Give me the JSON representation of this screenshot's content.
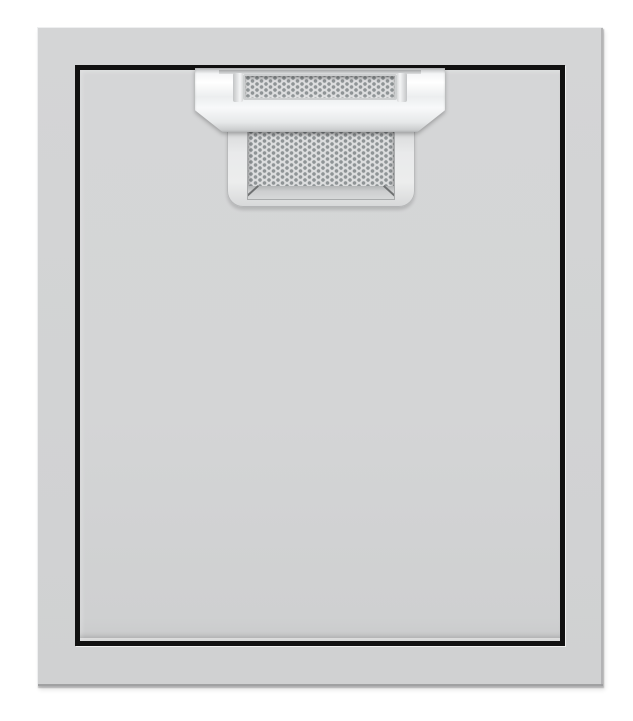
{
  "image": {
    "description": "Product photo of a brushed stainless steel single access door with a black reveal and a top-center pull handle that has a perforated metal insert and a recessed perforated finger pocket"
  },
  "colors": {
    "bg": "#ffffff",
    "frame": "#d4d5d6",
    "frame_edge_light": "#eeeff0",
    "frame_edge_dark": "#98999a",
    "panel": "#d5d6d7",
    "reveal": "#111111",
    "handle_bright": "#f4f5f6",
    "handle_mid": "#eceeef",
    "handle_shadow": "#bfc1c2",
    "perf_base": "#dcddde",
    "perf_dot": "#8f9496"
  },
  "elements": {
    "door_frame": "outer-mounting-frame",
    "door_reveal": "black-gap-between-frame-and-door",
    "door_panel": "door-face",
    "handle_bar": "pull-handle-bar",
    "handle_insert": "perforated-insert",
    "handle_pocket": "recessed-finger-pocket"
  }
}
